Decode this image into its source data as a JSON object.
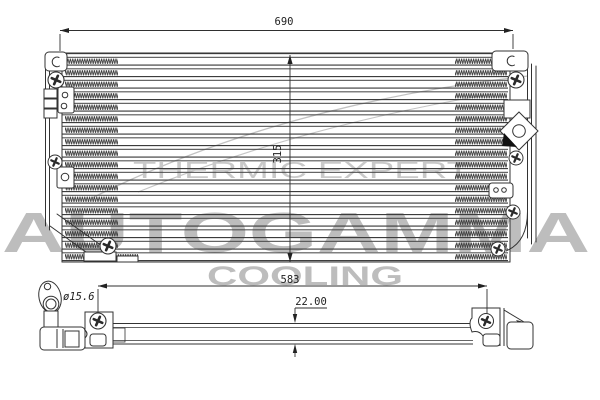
{
  "brandmark": {
    "name": "AUTOGAMMA",
    "subtitle": "COOLING",
    "tagline": "THERMIC EXPERT"
  },
  "dims": {
    "overall_width": "690",
    "core_height": "315",
    "mounting_span": "583",
    "depth": "22.00",
    "fitting_diameter": "ø15.6"
  },
  "colors": {
    "line": "#333333",
    "watermark": "#bdbdbd",
    "tagline": "#c9c9c9",
    "dim_text": "#1f1f1f",
    "background": "#ffffff"
  }
}
